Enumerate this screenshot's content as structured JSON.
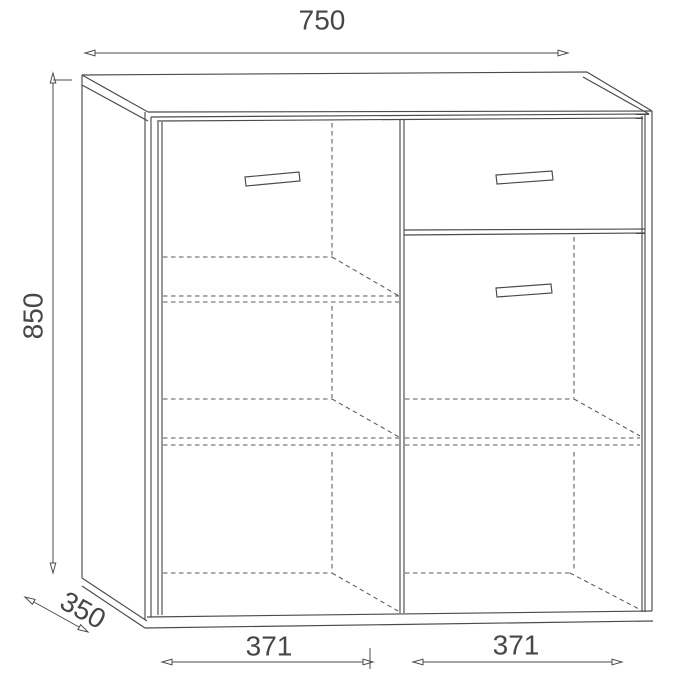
{
  "drawing": {
    "subject": "cabinet-technical-projection",
    "background_color": "#ffffff",
    "line_color": "#4b4b4b",
    "hidden_line_color": "#585858",
    "text_color": "#474747",
    "dimensions": {
      "overall_width": {
        "value": "750",
        "position": "top",
        "orientation": "horizontal"
      },
      "overall_height": {
        "value": "850",
        "position": "left",
        "orientation": "vertical"
      },
      "depth": {
        "value": "350",
        "position": "bottom-left",
        "orientation": "diagonal"
      },
      "left_compartment_width": {
        "value": "371",
        "position": "bottom-left-of-center",
        "orientation": "horizontal"
      },
      "right_compartment_width": {
        "value": "371",
        "position": "bottom-right-of-center",
        "orientation": "horizontal"
      }
    },
    "components": {
      "left_door": "full-height-door-with-handle",
      "top_right_drawer": "drawer-with-handle",
      "right_door": "door-with-handle",
      "interior_shelves": "hidden-dashed-lines"
    }
  }
}
